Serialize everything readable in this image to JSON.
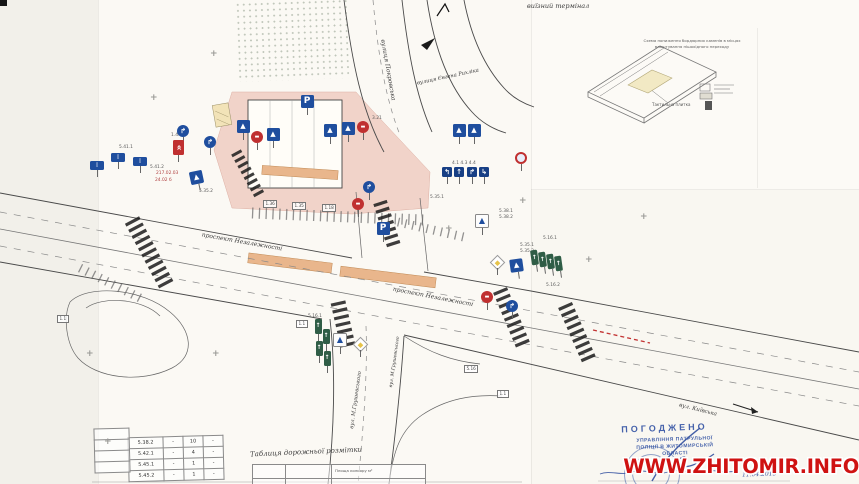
{
  "colors": {
    "sign_blue": "#1f4e9e",
    "sign_dark_blue": "#173f85",
    "sign_red": "#c03030",
    "lane_green": "#2f5d46",
    "stamp_blue": "#2c4da0",
    "watermark_red": "#cf1212",
    "building_pink": "#f1cfc5",
    "hump_tan": "#e9b68c",
    "tactile_yellow": "#f2e9c4"
  },
  "page": {
    "top_note": "виїзний термінал",
    "watermark": "WWW.ZHITOMIR.INFO"
  },
  "inset": {
    "caption1": "Схема пониження бордюрних каменів в місцях",
    "caption2": "влаштування пішохідного переходу",
    "tactile_label": "Тактильна плитка"
  },
  "street_labels": [
    {
      "text": "вулиця Покровська",
      "x": 388,
      "y": 70,
      "rot": 80,
      "size": 6
    },
    {
      "text": "вулиця Євгена Рихліка",
      "x": 448,
      "y": 77,
      "rot": -12,
      "size": 5.2
    },
    {
      "text": "проспект Незалежності",
      "x": 242,
      "y": 242,
      "rot": 10,
      "size": 6
    },
    {
      "text": "проспект Незалежності",
      "x": 433,
      "y": 297,
      "rot": 11,
      "size": 6
    },
    {
      "text": "вул. М.Грушевського",
      "x": 356,
      "y": 400,
      "rot": -82,
      "size": 5.2
    },
    {
      "text": "вул. М.Грушевського",
      "x": 395,
      "y": 362,
      "rot": -82,
      "size": 4.6
    },
    {
      "text": "вул. Київська",
      "x": 698,
      "y": 410,
      "rot": 14,
      "size": 5.5
    }
  ],
  "annotations": [
    {
      "t": "5.38.1",
      "x": 499,
      "y": 210
    },
    {
      "t": "5.38.2",
      "x": 499,
      "y": 216
    },
    {
      "t": "5.35.1",
      "x": 520,
      "y": 244
    },
    {
      "t": "5.35.2",
      "x": 520,
      "y": 250
    },
    {
      "t": "5.16.1",
      "x": 543,
      "y": 237
    },
    {
      "t": "5.16.2",
      "x": 546,
      "y": 284
    },
    {
      "t": "5.16.1",
      "x": 308,
      "y": 315
    },
    {
      "t": "3.21",
      "x": 372,
      "y": 117
    },
    {
      "t": "5.41.1",
      "x": 119,
      "y": 146
    },
    {
      "t": "5.41.2",
      "x": 150,
      "y": 166
    },
    {
      "t": "4.1  4.3  4.4",
      "x": 452,
      "y": 162
    },
    {
      "t": "5.35.2",
      "x": 199,
      "y": 190
    },
    {
      "t": "5.35.1",
      "x": 430,
      "y": 196
    },
    {
      "t": "1.4.1",
      "x": 171,
      "y": 134
    },
    {
      "t": "217.02.03",
      "x": 156,
      "y": 172,
      "c": "red"
    },
    {
      "t": "24.02 б",
      "x": 155,
      "y": 179,
      "c": "red"
    }
  ],
  "boxed_marks": [
    {
      "t": "1.36",
      "x": 263,
      "y": 200
    },
    {
      "t": "1.35",
      "x": 292,
      "y": 202
    },
    {
      "t": "1.18",
      "x": 322,
      "y": 204
    },
    {
      "t": "1.1",
      "x": 296,
      "y": 320
    },
    {
      "t": "1.1",
      "x": 57,
      "y": 315
    },
    {
      "t": "5.16",
      "x": 464,
      "y": 365
    },
    {
      "t": "1.1",
      "x": 497,
      "y": 390
    }
  ],
  "cross_marks": [
    [
      210,
      50
    ],
    [
      150,
      94
    ],
    [
      86,
      350
    ],
    [
      212,
      350
    ],
    [
      445,
      225
    ],
    [
      519,
      197
    ],
    [
      640,
      213
    ],
    [
      104,
      438
    ],
    [
      585,
      256
    ]
  ],
  "sign_types": {
    "parking": {
      "shape": "sq",
      "bg": "#1f4e9e",
      "fg": "#fff",
      "glyph": "P",
      "w": 13,
      "h": 13,
      "fs": 9
    },
    "ped": {
      "shape": "sq",
      "bg": "#1f4e9e",
      "fg": "#fff",
      "glyph": "▲",
      "w": 13,
      "h": 13,
      "fs": 7
    },
    "lane-sq": {
      "shape": "sq",
      "bg": "#173f85",
      "fg": "#fff",
      "glyph": "↑",
      "w": 10,
      "h": 10,
      "fs": 7
    },
    "info": {
      "shape": "sq",
      "bg": "#1f4e9e",
      "fg": "#fff",
      "glyph": "▯",
      "w": 14,
      "h": 9,
      "fs": 5
    },
    "no-entry": {
      "shape": "circle",
      "bg": "#c03030",
      "fg": "#fff",
      "glyph": "▬",
      "w": 12,
      "h": 12,
      "fs": 5
    },
    "prohibit": {
      "shape": "ring",
      "bg": "#e8eefa",
      "fg": "#c03030",
      "glyph": "",
      "w": 12,
      "h": 12,
      "fs": 6
    },
    "round-blue": {
      "shape": "circle",
      "bg": "#1f4e9e",
      "fg": "#fff",
      "glyph": "↱",
      "w": 12,
      "h": 12,
      "fs": 7
    },
    "chevron": {
      "shape": "sq",
      "bg": "#c03030",
      "fg": "#fff",
      "glyph": "«",
      "w": 11,
      "h": 15,
      "fs": 9,
      "grot": 90
    },
    "diamond": {
      "shape": "diamond",
      "bg": "#ffffff",
      "fg": "#e6c34a",
      "glyph": "",
      "w": 11,
      "h": 11,
      "fs": 5
    },
    "tri-frame": {
      "shape": "sq",
      "bg": "#fdfdfd",
      "fg": "#1f4e9e",
      "glyph": "▲",
      "w": 14,
      "h": 14,
      "fs": 8,
      "border": "#888"
    },
    "lane-bar": {
      "shape": "sq",
      "bg": "#2f5d46",
      "fg": "#fff",
      "glyph": "↑",
      "w": 7,
      "h": 15,
      "fs": 6
    }
  },
  "signs": [
    {
      "type": "parking",
      "x": 307,
      "y": 101
    },
    {
      "type": "ped",
      "x": 243,
      "y": 126
    },
    {
      "type": "no-entry",
      "x": 257,
      "y": 137
    },
    {
      "type": "ped",
      "x": 273,
      "y": 134
    },
    {
      "type": "ped",
      "x": 330,
      "y": 130
    },
    {
      "type": "ped",
      "x": 348,
      "y": 128
    },
    {
      "type": "no-entry",
      "x": 363,
      "y": 127
    },
    {
      "type": "round-blue",
      "x": 210,
      "y": 142
    },
    {
      "type": "round-blue",
      "x": 183,
      "y": 131
    },
    {
      "type": "chevron",
      "x": 178,
      "y": 147
    },
    {
      "type": "ped",
      "x": 196,
      "y": 177,
      "rot": -12
    },
    {
      "type": "info",
      "x": 118,
      "y": 157
    },
    {
      "type": "info",
      "x": 140,
      "y": 161
    },
    {
      "type": "info",
      "x": 97,
      "y": 165
    },
    {
      "type": "round-blue",
      "x": 369,
      "y": 187
    },
    {
      "type": "no-entry",
      "x": 358,
      "y": 204
    },
    {
      "type": "parking",
      "x": 383,
      "y": 228
    },
    {
      "type": "ped",
      "x": 459,
      "y": 130
    },
    {
      "type": "ped",
      "x": 474,
      "y": 130
    },
    {
      "type": "prohibit",
      "x": 521,
      "y": 158
    },
    {
      "type": "lane-sq",
      "x": 447,
      "y": 172,
      "glyph": "↰"
    },
    {
      "type": "lane-sq",
      "x": 459,
      "y": 172,
      "glyph": "↑"
    },
    {
      "type": "lane-sq",
      "x": 472,
      "y": 172,
      "glyph": "↱"
    },
    {
      "type": "lane-sq",
      "x": 484,
      "y": 172,
      "glyph": "↳"
    },
    {
      "type": "tri-frame",
      "x": 482,
      "y": 221
    },
    {
      "type": "diamond",
      "x": 497,
      "y": 262
    },
    {
      "type": "ped",
      "x": 516,
      "y": 265,
      "rot": -8
    },
    {
      "type": "lane-bar",
      "x": 534,
      "y": 257,
      "rot": -8
    },
    {
      "type": "lane-bar",
      "x": 542,
      "y": 259,
      "rot": -8
    },
    {
      "type": "lane-bar",
      "x": 550,
      "y": 261,
      "rot": -8
    },
    {
      "type": "lane-bar",
      "x": 558,
      "y": 263,
      "rot": -8
    },
    {
      "type": "lane-bar",
      "x": 318,
      "y": 326
    },
    {
      "type": "lane-bar",
      "x": 326,
      "y": 336
    },
    {
      "type": "lane-bar",
      "x": 319,
      "y": 348
    },
    {
      "type": "lane-bar",
      "x": 327,
      "y": 358
    },
    {
      "type": "tri-frame",
      "x": 340,
      "y": 340
    },
    {
      "type": "diamond",
      "x": 360,
      "y": 344
    },
    {
      "type": "no-entry",
      "x": 487,
      "y": 297
    },
    {
      "type": "round-blue",
      "x": 512,
      "y": 306
    }
  ],
  "sign_table": {
    "rows": [
      [
        "5.38.2",
        "-",
        "10",
        "-"
      ],
      [
        "5.42.1",
        "-",
        "4",
        "-"
      ],
      [
        "5.45.1",
        "-",
        "1",
        "-"
      ],
      [
        "5.45.2",
        "-",
        "1",
        "-"
      ]
    ]
  },
  "marking_table": {
    "title": "Таблиця дорожньої розмітки",
    "col_header": "Площа кольору м²"
  },
  "stamp": {
    "approved": "ПОГОДЖЕНО",
    "lines": [
      "УПРАВЛІННЯ ПАТРУЛЬНОЇ",
      "ПОЛІЦІЇ В ЖИТОМИРСЬКІЙ",
      "ОБЛАСТІ"
    ],
    "handwritten_date": "11.04.2015"
  }
}
